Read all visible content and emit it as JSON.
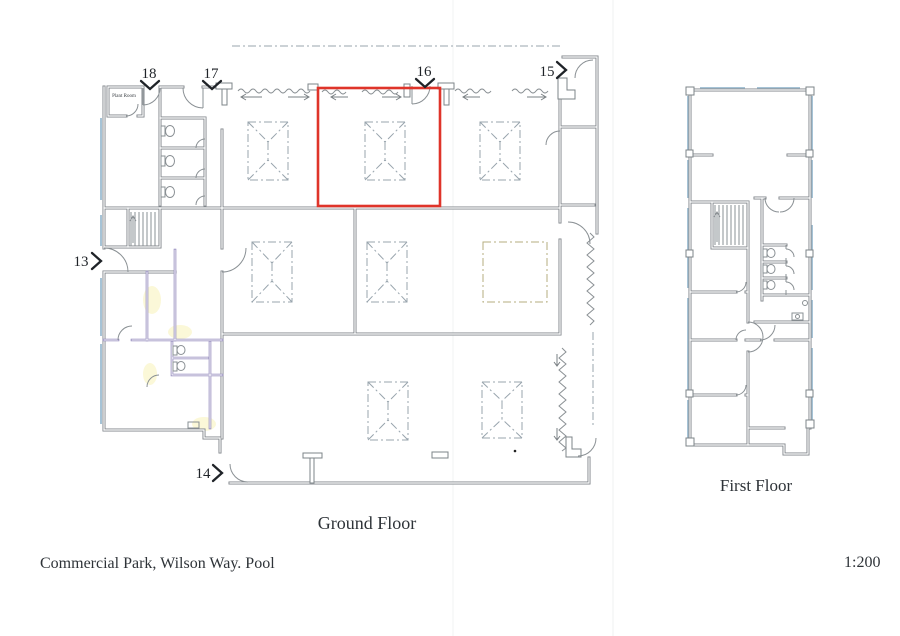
{
  "document": {
    "title": "Commercial Park, Wilson Way. Pool",
    "scale": "1:200"
  },
  "plans": {
    "ground": {
      "caption": "Ground Floor"
    },
    "first": {
      "caption": "First Floor"
    }
  },
  "rooms": {
    "plant_room": "Plant Room"
  },
  "markers": {
    "m13": {
      "label": "13",
      "direction": "right"
    },
    "m14": {
      "label": "14",
      "direction": "right"
    },
    "m15": {
      "label": "15",
      "direction": "right"
    },
    "m16": {
      "label": "16",
      "direction": "down"
    },
    "m17": {
      "label": "17",
      "direction": "down"
    },
    "m18": {
      "label": "18",
      "direction": "down"
    }
  },
  "highlight": {
    "color": "#df342a"
  },
  "colors": {
    "wall": "#80868b",
    "window": "#a6c3d6",
    "partition": "#8f86ba",
    "skylight": "#98a4ad",
    "skylight_alt": "#b5ae7f",
    "ink": "#1f2328"
  }
}
